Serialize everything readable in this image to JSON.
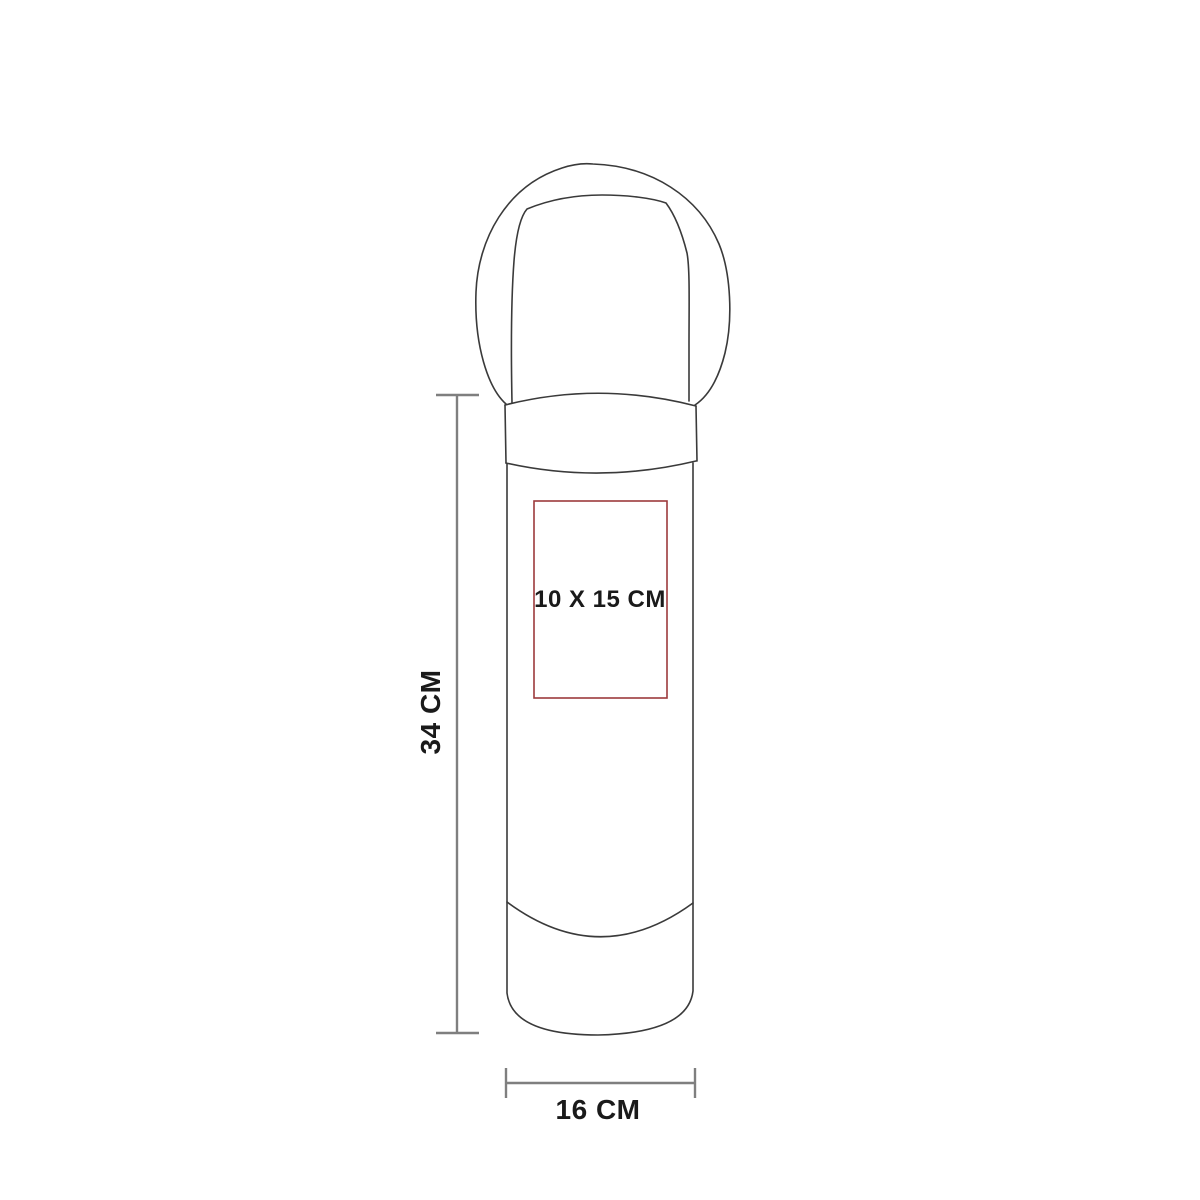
{
  "figure": {
    "height_label": "34 CM",
    "width_label": "16 CM",
    "print_area_label": "10 X 15 CM"
  },
  "colors": {
    "background": "#ffffff",
    "product_outline": "#3a3a3a",
    "dimension_line": "#7f7f7f",
    "print_area_border": "#9c3a3c",
    "label_text": "#1a1a1a"
  }
}
